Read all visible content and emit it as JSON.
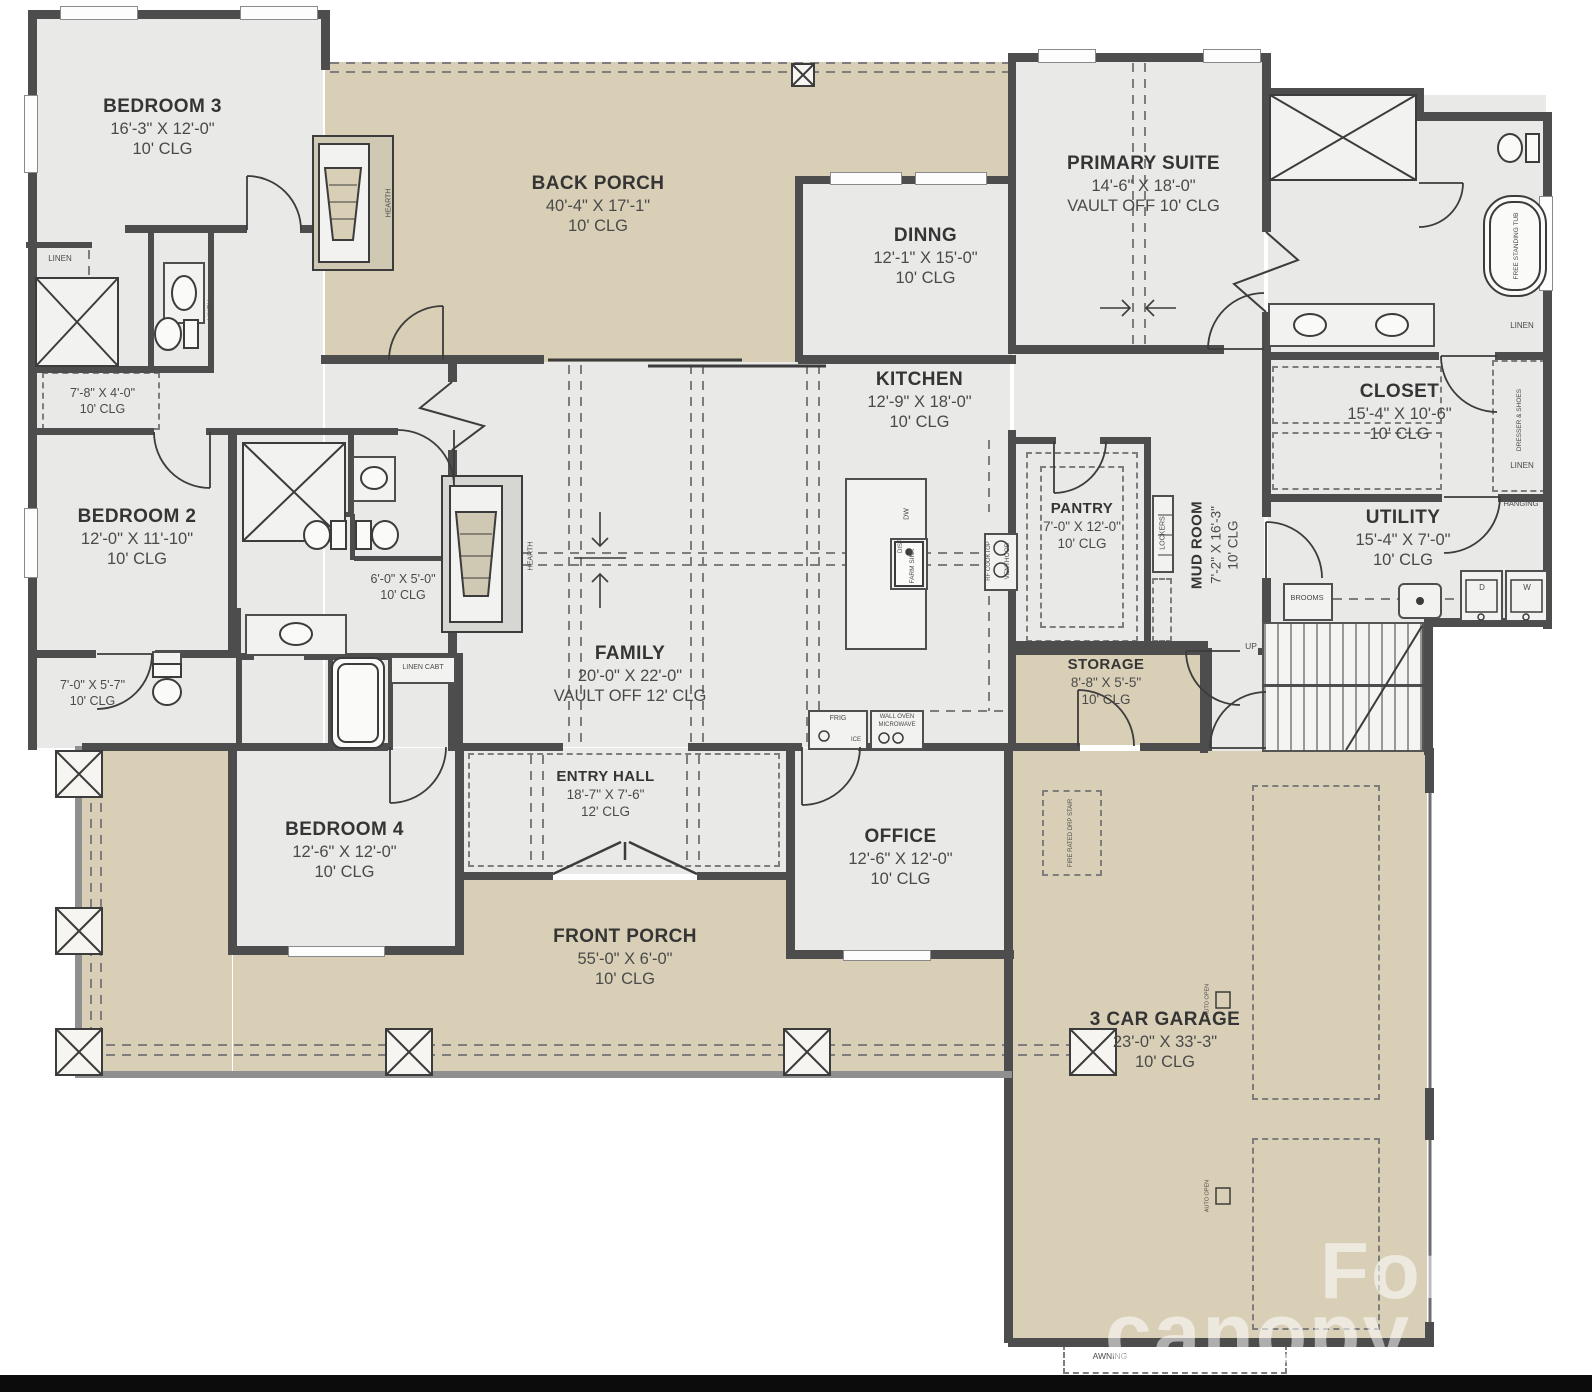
{
  "colors": {
    "wall": "#4d4d4d",
    "porch_tan": "#d8cfb6",
    "interior_gray": "#e9e9e7",
    "dash": "#7d7d7d",
    "text": "#3e3e3e",
    "watermark": "rgba(255,255,255,0.55)"
  },
  "rooms": {
    "bedroom3": {
      "name": "BEDROOM 3",
      "dims": "16'-3\" X 12'-0\"",
      "clg": "10' CLG"
    },
    "back_porch": {
      "name": "BACK PORCH",
      "dims": "40'-4\" X 17'-1\"",
      "clg": "10' CLG"
    },
    "dinng": {
      "name": "DINNG",
      "dims": "12'-1\" X 15'-0\"",
      "clg": "10' CLG"
    },
    "primary": {
      "name": "PRIMARY SUITE",
      "dims": "14'-6\" X 18'-0\"",
      "clg": "VAULT OFF 10' CLG"
    },
    "kitchen": {
      "name": "KITCHEN",
      "dims": "12'-9\" X 18'-0\"",
      "clg": "10' CLG"
    },
    "closet": {
      "name": "CLOSET",
      "dims": "15'-4\" X 10'-6\"",
      "clg": "10' CLG"
    },
    "bedroom2": {
      "name": "BEDROOM 2",
      "dims": "12'-0\" X 11'-10\"",
      "clg": "10' CLG"
    },
    "pantry": {
      "name": "PANTRY",
      "dims": "7'-0\" X 12'-0\"",
      "clg": "10' CLG"
    },
    "mud": {
      "name": "MUD ROOM",
      "dims": "7'-2\" X 16'-3\"",
      "clg": "10' CLG"
    },
    "utility": {
      "name": "UTILITY",
      "dims": "15'-4\" X 7'-0\"",
      "clg": "10' CLG"
    },
    "family": {
      "name": "FAMILY",
      "dims": "20'-0\" X 22'-0\"",
      "clg": "VAULT OFF 12' CLG"
    },
    "storage": {
      "name": "STORAGE",
      "dims": "8'-8\" X 5'-5\"",
      "clg": "10' CLG"
    },
    "bedroom4": {
      "name": "BEDROOM 4",
      "dims": "12'-6\" X 12'-0\"",
      "clg": "10' CLG"
    },
    "entry": {
      "name": "ENTRY HALL",
      "dims": "18'-7\" X 7'-6\"",
      "clg": "12' CLG"
    },
    "office": {
      "name": "OFFICE",
      "dims": "12'-6\" X 12'-0\"",
      "clg": "10' CLG"
    },
    "front_porch": {
      "name": "FRONT PORCH",
      "dims": "55'-0\" X 6'-0\"",
      "clg": "10' CLG"
    },
    "garage": {
      "name": "3 CAR GARAGE",
      "dims": "23'-0\" X 33'-3\"",
      "clg": "10' CLG"
    },
    "hall_a": {
      "dims": "7'-8\" X 4'-0\"",
      "clg": "10' CLG"
    },
    "hall_b": {
      "dims": "6'-0\" X 5'-0\"",
      "clg": "10' CLG"
    },
    "hall_c": {
      "dims": "7'-0\" X 5'-7\"",
      "clg": "10' CLG"
    }
  },
  "labels": {
    "linen": "LINEN",
    "hanging": "HANGING",
    "dresser_shoes": "DRESSER & SHOES",
    "linen_cabt": "LINEN CABT",
    "brooms": "BROOMS",
    "lockers": "LOCKERS",
    "hearth": "HEARTH",
    "free_tub": "FREE STANDING TUB",
    "frig": "FRIG",
    "ice": "ICE",
    "wall_oven": "WALL OVEN",
    "microwave": "MICROWAVE",
    "dw": "DW",
    "disp": "DISP",
    "farm_sink": "FARM SINK",
    "venthood": "VENTHOOD",
    "cooktop": "RF COOKTOP",
    "up": "UP",
    "fire_stair": "FIRE RATED DRP STAIR",
    "auto_open": "AUTO OPEN",
    "awning": "AWNING",
    "dryer": "D",
    "washer": "W"
  },
  "watermark": {
    "line1": "For",
    "line2": "canopy"
  }
}
